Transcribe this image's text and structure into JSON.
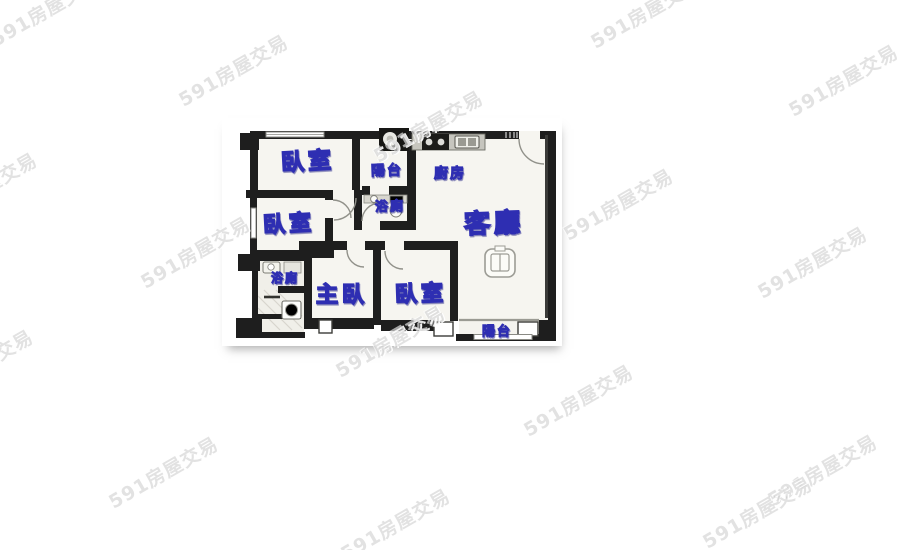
{
  "watermark": {
    "text": "591房屋交易",
    "color_css": "rgba(160,160,160,0.30)",
    "positions": [
      {
        "x": 45,
        "y": 10
      },
      {
        "x": 645,
        "y": 12
      },
      {
        "x": 233,
        "y": 70
      },
      {
        "x": 843,
        "y": 80
      },
      {
        "x": 428,
        "y": 126
      },
      {
        "x": -18,
        "y": 188
      },
      {
        "x": 618,
        "y": 204
      },
      {
        "x": 195,
        "y": 252
      },
      {
        "x": 812,
        "y": 262
      },
      {
        "x": -22,
        "y": 365
      },
      {
        "x": 390,
        "y": 341
      },
      {
        "x": 578,
        "y": 400
      },
      {
        "x": 163,
        "y": 472
      },
      {
        "x": 822,
        "y": 470
      },
      {
        "x": 757,
        "y": 512
      },
      {
        "x": 395,
        "y": 524
      }
    ]
  },
  "floorplan": {
    "label_color": "#2e2eb2",
    "rooms": [
      {
        "id": "bedroom-top-left",
        "label": "臥室"
      },
      {
        "id": "balcony-top",
        "label": "陽台"
      },
      {
        "id": "kitchen",
        "label": "廚房"
      },
      {
        "id": "bathroom-middle",
        "label": "浴廁"
      },
      {
        "id": "living-room",
        "label": "客廳"
      },
      {
        "id": "bedroom-left",
        "label": "臥室"
      },
      {
        "id": "bathroom-lower-left",
        "label": "浴廁"
      },
      {
        "id": "master-bedroom",
        "label": "主臥"
      },
      {
        "id": "bedroom-bottom",
        "label": "臥室"
      },
      {
        "id": "balcony-bottom",
        "label": "陽台"
      }
    ]
  }
}
